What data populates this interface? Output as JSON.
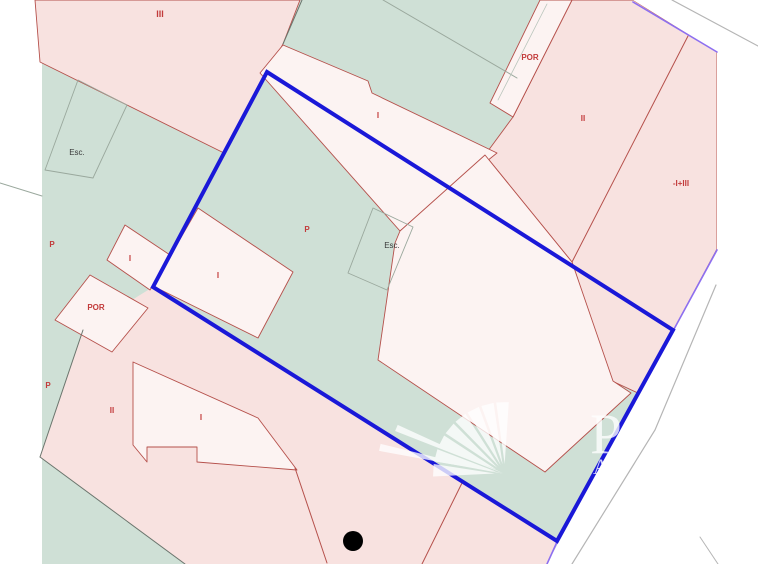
{
  "canvas": {
    "width": 758,
    "height": 564,
    "background": "#ffffff"
  },
  "colors": {
    "parcel_pink": "#f8e2e0",
    "parcel_white": "#fcf3f2",
    "block_green": "#cfe0d6",
    "road_white": "#ffffff",
    "red_line": "#b5504b",
    "red_label": "#c23b3b",
    "dark_label": "#3a3a3a",
    "selection_blue": "#1a18d8",
    "adjacent_purple": "#8d6ff0",
    "road_gray": "#b5b5b5",
    "inner_gray": "#9aa89d",
    "dark_line": "#6b756d",
    "marker_black": "#000000",
    "watermark_white": "#ffffff"
  },
  "map": {
    "polygons": [
      {
        "name": "block-green-base",
        "points": "42,0 717,0 717,249 547,564 42,564",
        "fill": "#cfe0d6",
        "stroke": "none",
        "stroke_width": 0,
        "interactable": false
      },
      {
        "name": "parcel-iii",
        "points": "35,0 300,0 283,44 224,153 40,62",
        "fill": "#f8e2e0",
        "stroke": "#b5504b",
        "stroke_width": 0.9,
        "interactable": true
      },
      {
        "name": "parcel-ii-right",
        "points": "572,0 633,0 717,52 717,249 673,331 640,394 612,381 572,262 485,155 513,117",
        "fill": "#f8e2e0",
        "stroke": "#b5504b",
        "stroke_width": 0.9,
        "interactable": true
      },
      {
        "name": "parcel-bottom-pink",
        "points": "153,287 557,542 547,564 185,564 40,457 83,330",
        "fill": "#f8e2e0",
        "stroke": "none",
        "stroke_width": 0,
        "interactable": true
      },
      {
        "name": "road-white-area",
        "points": "633,0 758,0 758,564 547,564 717,249 717,52",
        "fill": "#ffffff",
        "stroke": "none",
        "stroke_width": 0,
        "interactable": false
      },
      {
        "name": "parcel-strip-i",
        "points": "283,45 368,81 372,93 497,153 400,231 260,73",
        "fill": "#fcf3f2",
        "stroke": "#b5504b",
        "stroke_width": 0.9,
        "interactable": true
      },
      {
        "name": "parcel-por-strip",
        "points": "540,0 572,0 513,117 490,103",
        "fill": "#fcf3f2",
        "stroke": "#b5504b",
        "stroke_width": 0.9,
        "interactable": true
      },
      {
        "name": "building-main",
        "points": "400,231 485,155 572,262 613,381 631,393 545,472 378,360 395,243",
        "fill": "#fcf3f2",
        "stroke": "#b5504b",
        "stroke_width": 0.9,
        "interactable": true
      },
      {
        "name": "parcel-i-center",
        "points": "198,208 293,272 258,338 153,286",
        "fill": "#fcf3f2",
        "stroke": "#b5504b",
        "stroke_width": 0.9,
        "interactable": true
      },
      {
        "name": "parcel-i-left",
        "points": "125,225 170,255 150,290 107,260",
        "fill": "#fcf3f2",
        "stroke": "#b5504b",
        "stroke_width": 0.9,
        "interactable": true
      },
      {
        "name": "parcel-por-left",
        "points": "90,275 148,308 112,352 55,320",
        "fill": "#fcf3f2",
        "stroke": "#b5504b",
        "stroke_width": 0.9,
        "interactable": true
      },
      {
        "name": "building-bottom-left",
        "points": "133,362 258,418 297,470 197,462 197,447 147,447 147,462 133,445",
        "fill": "#fcf3f2",
        "stroke": "#b5504b",
        "stroke_width": 0.9,
        "interactable": true
      },
      {
        "name": "stairwell-outline-center",
        "points": "373,208 413,227 387,290 348,273",
        "fill": "none",
        "stroke": "#9aa89d",
        "stroke_width": 0.9,
        "interactable": false
      },
      {
        "name": "stairwell-outline-left",
        "points": "78,80 127,105 93,178 45,170",
        "fill": "none",
        "stroke": "#9aa89d",
        "stroke_width": 0.9,
        "interactable": false
      }
    ],
    "lines": [
      {
        "name": "red-divider-top-right",
        "points": "688,36 572,262",
        "color": "#b5504b",
        "width": 1
      },
      {
        "name": "red-divider-bottom-left",
        "points": "295,468 327,563",
        "color": "#b5504b",
        "width": 1
      },
      {
        "name": "red-divider-bottom-mid",
        "points": "462,483 422,564",
        "color": "#b5504b",
        "width": 1
      },
      {
        "name": "gray-boundary-top-mid",
        "points": "383,0 517,78",
        "color": "#9aa89d",
        "width": 1
      },
      {
        "name": "gray-inner-por-strip",
        "points": "547,4 498,100",
        "color": "#b8c4bb",
        "width": 0.8
      },
      {
        "name": "dark-edge-top",
        "points": "302,0 283,44",
        "color": "#6b756d",
        "width": 1
      },
      {
        "name": "dark-edge-left-upper",
        "points": "0,183 42,196",
        "color": "#9aa89d",
        "width": 1
      },
      {
        "name": "dark-edge-left-lower-1",
        "points": "83,330 40,457",
        "color": "#6b756d",
        "width": 1
      },
      {
        "name": "dark-edge-left-lower-2",
        "points": "40,457 185,564",
        "color": "#6b756d",
        "width": 1
      },
      {
        "name": "road-gray-top",
        "points": "672,0 758,46",
        "color": "#b5b5b5",
        "width": 1.2
      },
      {
        "name": "road-gray-right",
        "points": "716,285 655,430 572,564",
        "color": "#b5b5b5",
        "width": 1.2
      },
      {
        "name": "road-gray-corner",
        "points": "700,537 718,564",
        "color": "#b5b5b5",
        "width": 1
      },
      {
        "name": "purple-boundary-top",
        "points": "633,2 717,52",
        "color": "#8d6ff0",
        "width": 1.6
      },
      {
        "name": "purple-boundary-right",
        "points": "717,250 673,331",
        "color": "#8d6ff0",
        "width": 1.6
      },
      {
        "name": "purple-boundary-bottom",
        "points": "557,542 547,564",
        "color": "#8d6ff0",
        "width": 1.6
      }
    ],
    "selection": {
      "name": "selected-parcel-outline",
      "points": "267,72 673,330 557,541 153,287",
      "color": "#1a18d8",
      "width": 4
    },
    "marker": {
      "name": "point-marker",
      "x": 353,
      "y": 541,
      "r": 10,
      "color": "#000000"
    },
    "labels": [
      {
        "text": "III",
        "x": 160,
        "y": 17,
        "color": "#c23b3b",
        "size": 9,
        "bold": true
      },
      {
        "text": "POR",
        "x": 530,
        "y": 60,
        "color": "#c23b3b",
        "size": 8,
        "bold": true
      },
      {
        "text": "I",
        "x": 378,
        "y": 118,
        "color": "#c23b3b",
        "size": 8,
        "bold": true
      },
      {
        "text": "II",
        "x": 583,
        "y": 121,
        "color": "#c23b3b",
        "size": 8,
        "bold": true
      },
      {
        "text": "-I+III",
        "x": 681,
        "y": 186,
        "color": "#c23b3b",
        "size": 8,
        "bold": true
      },
      {
        "text": "Esc.",
        "x": 77,
        "y": 155,
        "color": "#3a3a3a",
        "size": 8,
        "bold": false
      },
      {
        "text": "P",
        "x": 307,
        "y": 232,
        "color": "#c23b3b",
        "size": 8,
        "bold": true
      },
      {
        "text": "Esc.",
        "x": 392,
        "y": 248,
        "color": "#3a3a3a",
        "size": 8,
        "bold": false
      },
      {
        "text": "P",
        "x": 52,
        "y": 247,
        "color": "#c23b3b",
        "size": 8,
        "bold": true
      },
      {
        "text": "I",
        "x": 130,
        "y": 261,
        "color": "#c23b3b",
        "size": 8,
        "bold": true
      },
      {
        "text": "POR",
        "x": 96,
        "y": 310,
        "color": "#c23b3b",
        "size": 8,
        "bold": true
      },
      {
        "text": "I",
        "x": 218,
        "y": 278,
        "color": "#c23b3b",
        "size": 8,
        "bold": true
      },
      {
        "text": "P",
        "x": 48,
        "y": 388,
        "color": "#c23b3b",
        "size": 8,
        "bold": true
      },
      {
        "text": "II",
        "x": 112,
        "y": 413,
        "color": "#c23b3b",
        "size": 8,
        "bold": true
      },
      {
        "text": "I",
        "x": 201,
        "y": 420,
        "color": "#c23b3b",
        "size": 8,
        "bold": true
      }
    ],
    "watermark": {
      "opacity": 0.78,
      "color": "#ffffff",
      "fan": {
        "cx": 505,
        "cy": 474,
        "inner": 10,
        "outer": 72,
        "start_angle": 183,
        "end_angle": 268,
        "blades": 8,
        "spread": 5
      },
      "rays": [
        {
          "angle": 192,
          "length": 128,
          "spread": 1.6
        },
        {
          "angle": 203,
          "length": 118,
          "spread": 1.6
        }
      ],
      "letters": [
        {
          "text": "P",
          "x": 606,
          "y": 453,
          "size": 57
        },
        {
          "text": "A",
          "x": 601,
          "y": 474,
          "size": 22
        }
      ]
    }
  }
}
